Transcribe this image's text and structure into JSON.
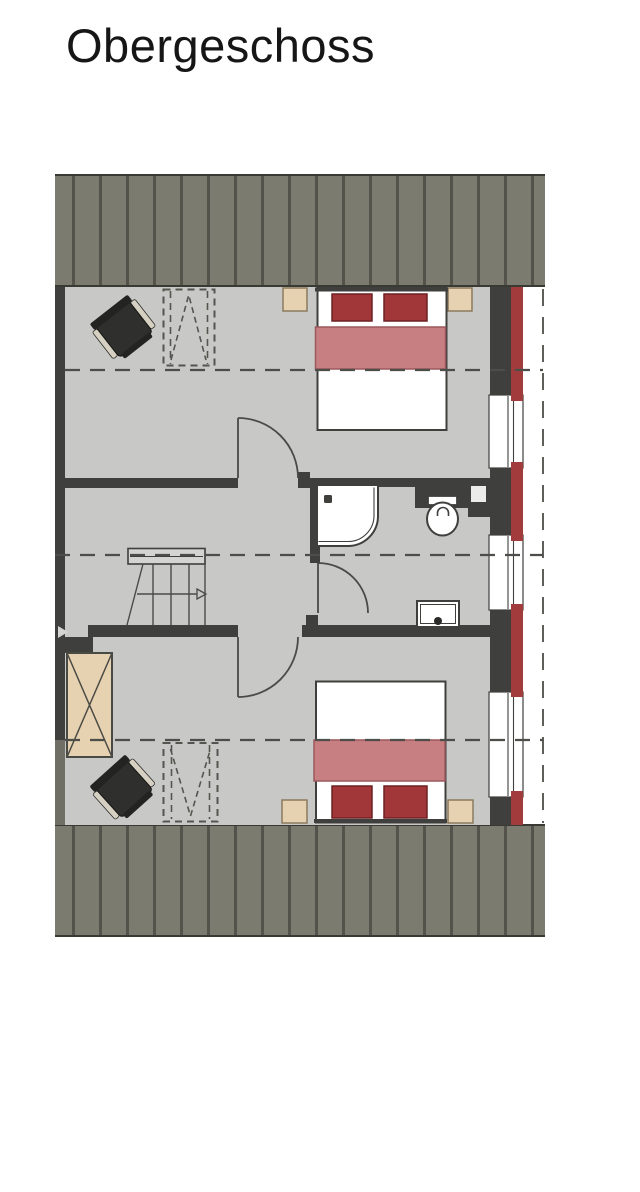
{
  "title": "Obergeschoss",
  "palette": {
    "page_bg": "#ffffff",
    "roof": "#7b7b6f",
    "roof_stripe": "#53534b",
    "roof_edge": "#3a3a34",
    "floor": "#c8c8c7",
    "wall": "#3f3f3d",
    "wall_under_roof": "#6f6f65",
    "cladding_red": "#a23c3c",
    "window_white": "#ffffff",
    "line": "#4a4a46",
    "dash_line": "#4d4d49",
    "pillow_red": "#a23739",
    "pillow_border": "#6d2022",
    "blanket_pink": "#c87f81",
    "blanket_border": "#9a585c",
    "furniture_beige": "#e6d1b0",
    "furniture_border": "#8a7a5e",
    "chair_dark": "#2f2f2d",
    "chair_light": "#d6d0c2",
    "title_color": "#161616"
  },
  "symbols": [
    "double-bed",
    "pillow",
    "blanket",
    "nightstand",
    "wardrobe",
    "chair",
    "skylight",
    "window",
    "facade-cladding",
    "shower",
    "toilet",
    "sink",
    "staircase",
    "door-swing",
    "guide-line",
    "roof-overhang"
  ]
}
